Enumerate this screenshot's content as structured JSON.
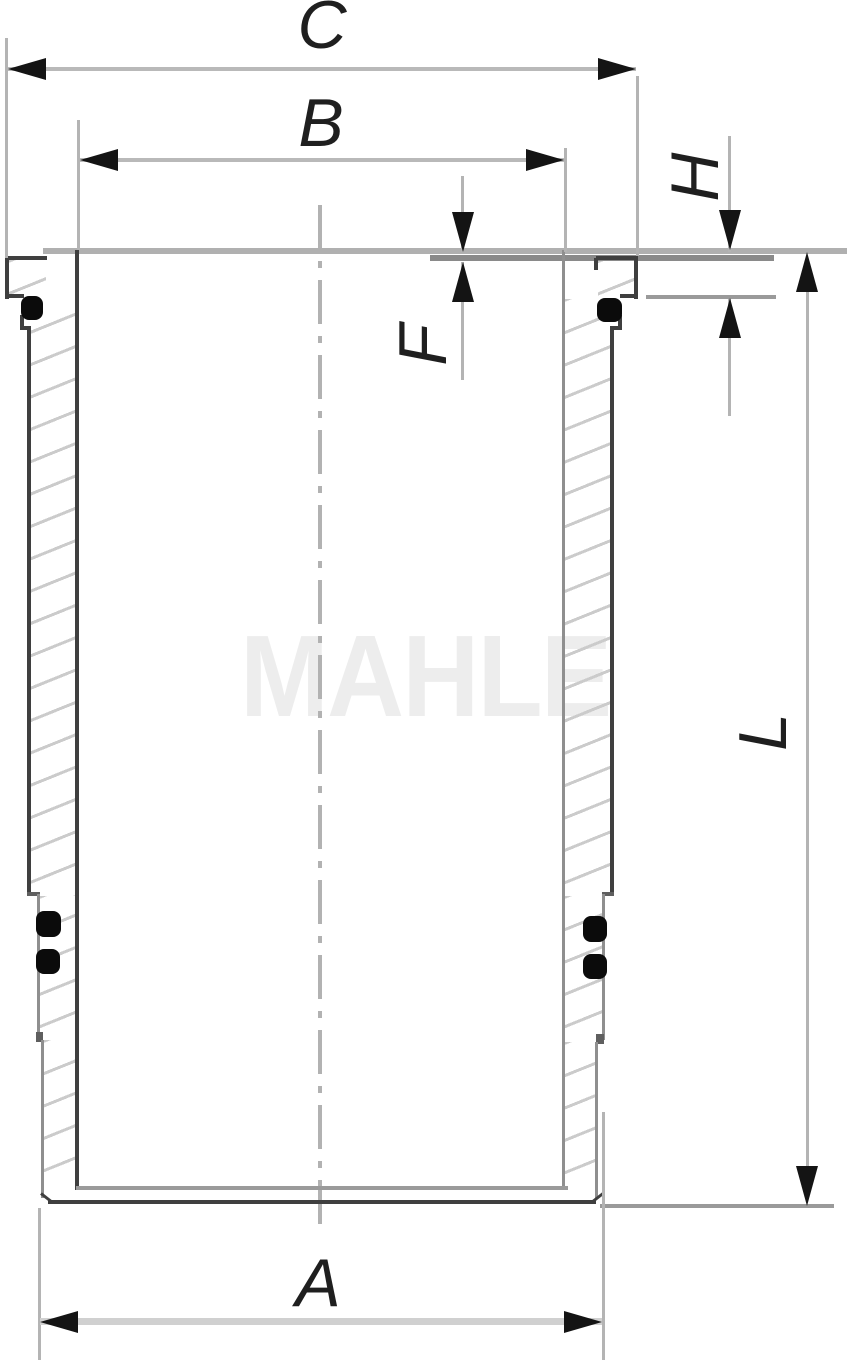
{
  "drawing": {
    "watermark": "MAHLE",
    "labels": {
      "c": "C",
      "b": "B",
      "h": "H",
      "f": "F",
      "l": "L",
      "a": "A"
    },
    "colors": {
      "background": "#ffffff",
      "outline_dark": "#3f3f3f",
      "outline_medium": "#8f8f8f",
      "dimension_line": "#c2c2c2",
      "extension_line": "#b4b4b4",
      "arrowhead": "#141414",
      "label_text": "#1f1f1f",
      "hatch": "#cbcbcb",
      "centerline": "#b2b2b2",
      "watermark": "#ededed",
      "seal": "#0b0b0b"
    }
  }
}
